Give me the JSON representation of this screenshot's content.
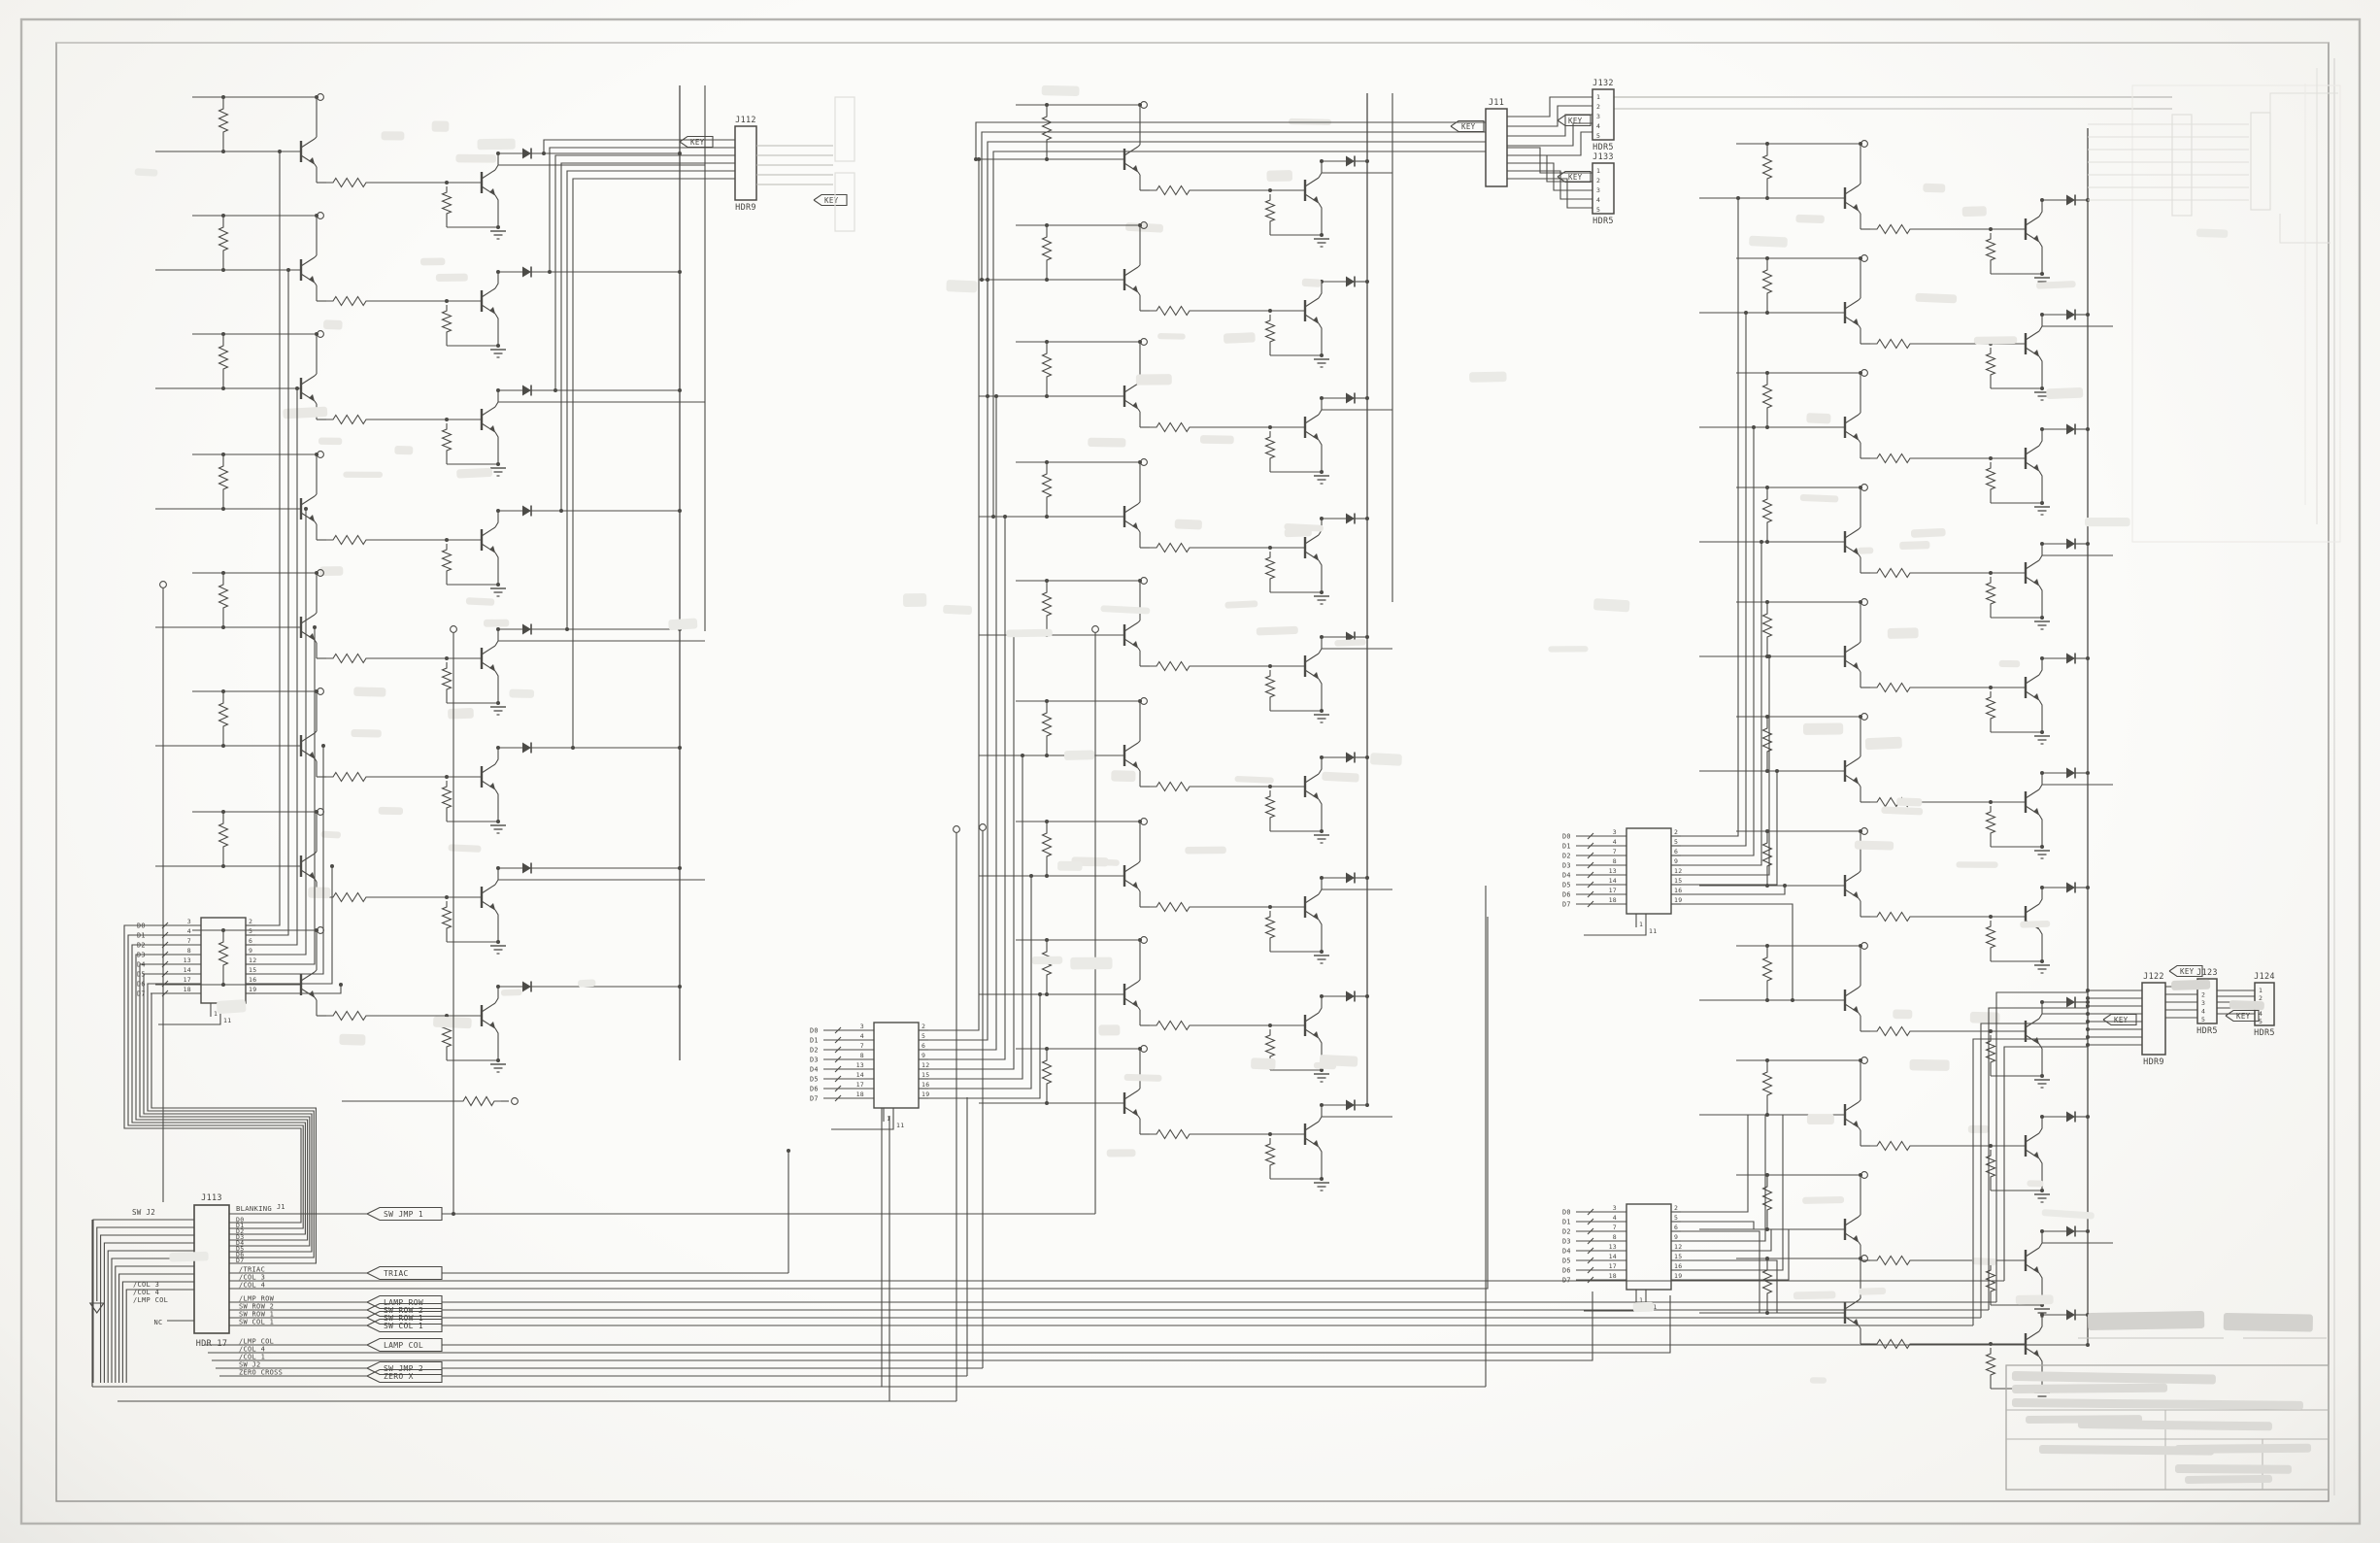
{
  "colors": {
    "paper": "#fafaf8",
    "ink": "#4c4b47",
    "ghost": "#e0dfdb",
    "text": "#454440",
    "border_outer": "#b5b4b0",
    "border_inner": "#93928e"
  },
  "labels": {
    "key": "KEY",
    "nc": "NC"
  },
  "connectors": {
    "j112": {
      "ref": "J112",
      "sub": "HDR9"
    },
    "j11": {
      "ref": "J11",
      "sub": ""
    },
    "j132": {
      "ref": "J132",
      "sub": "HDR5",
      "pins": [
        "1",
        "2",
        "3",
        "4",
        "5"
      ]
    },
    "j133": {
      "ref": "J133",
      "sub": "HDR5",
      "pins": [
        "1",
        "2",
        "3",
        "4",
        "5"
      ]
    },
    "j122": {
      "ref": "J122",
      "sub": "HDR9"
    },
    "j123": {
      "ref": "J123",
      "sub": "HDR5",
      "pins": [
        "1",
        "2",
        "3",
        "4",
        "5"
      ]
    },
    "j124": {
      "ref": "J124",
      "sub": "HDR5",
      "pins": [
        "1",
        "2",
        "3",
        "4",
        "5"
      ]
    },
    "j113": {
      "ref": "J113",
      "sub": "HDR 17"
    }
  },
  "j113": {
    "top_net_ref": "J1",
    "top_net": "BLANKING",
    "data_bus": [
      "D0",
      "D1",
      "D2",
      "D3",
      "D4",
      "D5",
      "D6",
      "D7"
    ],
    "mid_signals": [
      "/TRIAC",
      "/COL 3",
      "/COL 4",
      "/LMP ROW",
      "SW ROW 2",
      "SW ROW 1",
      "SW COL 1"
    ],
    "low_signals": [
      "/LMP COL",
      "/COL 4",
      "/COL 1",
      "SW J2",
      "ZERO CROSS"
    ],
    "left_labels": [
      "/COL 3",
      "/COL 4",
      "/LMP COL"
    ],
    "input_net": "SW J2",
    "nc": "NC"
  },
  "flag_list": [
    "SW JMP 1",
    "TRIAC",
    "LAMP ROW",
    "SW ROW 2",
    "SW ROW 1",
    "SW COL 1",
    "LAMP COL",
    "SW JMP 2",
    "ZERO X"
  ],
  "latch": {
    "left_pins": [
      "3",
      "4",
      "7",
      "8",
      "13",
      "14",
      "17",
      "18"
    ],
    "right_pins": [
      "2",
      "5",
      "6",
      "9",
      "12",
      "15",
      "16",
      "19"
    ],
    "ctrl_pins": [
      "1",
      "11"
    ],
    "bus": [
      "D0",
      "D1",
      "D2",
      "D3",
      "D4",
      "D5",
      "D6",
      "D7"
    ]
  }
}
